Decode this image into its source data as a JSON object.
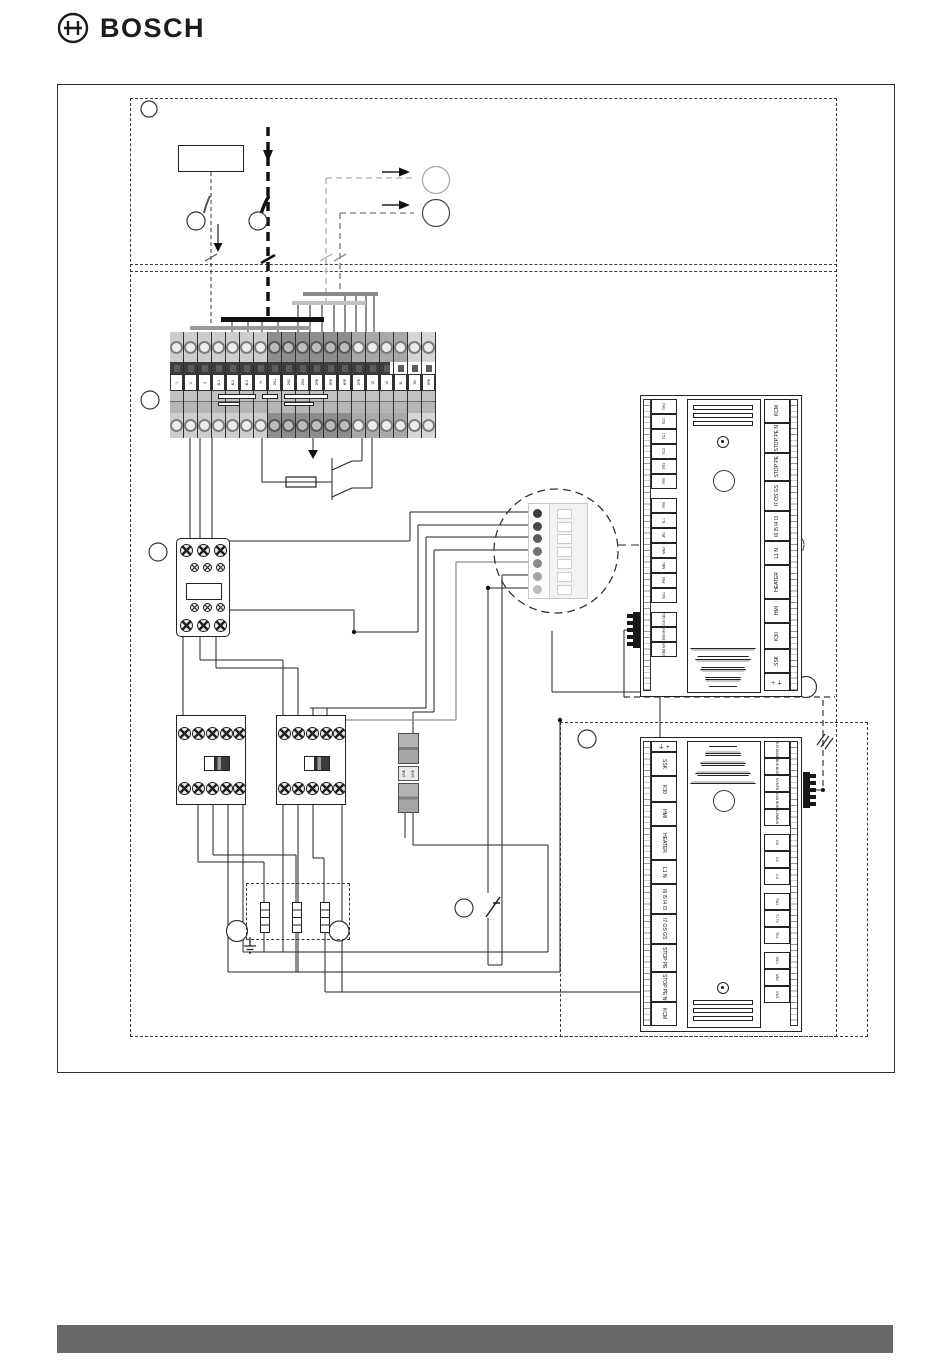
{
  "brand": {
    "logo_text": "BOSCH"
  },
  "footer": {
    "bar_color": "#686868"
  },
  "diagram": {
    "terminal_strip": {
      "labels": [
        "1",
        "2",
        "3",
        "4L1",
        "4L2",
        "4L3",
        "N",
        "2N1",
        "2N2",
        "2N3",
        "2PE",
        "3PE",
        "4PE",
        "1PE",
        "15",
        "16",
        "3L",
        "3N",
        "5PE"
      ]
    },
    "din_terminal": {
      "labels": [
        "1/NE",
        "2/NE"
      ]
    },
    "connector": {
      "pin_count": "7"
    },
    "board_top": {
      "left_labels": [
        "TW1",
        "TC0",
        "TC1",
        "TC3",
        "TR3",
        "TR5",
        "TR6",
        "TL1",
        "JR1",
        "MK2",
        "MB1",
        "PK5",
        "SO1",
        "SD08 SD18",
        "STB8 MVC",
        "STB8 MV3"
      ],
      "right_labels": [
        "KCM",
        "STOP PE N",
        "STOP PE",
        "I7 OS GS",
        "I6 I5 I4 I3",
        "L1 N",
        "HEATER",
        "HMI",
        "K30",
        "SSK"
      ],
      "symbol_cell": "+ ⏚"
    },
    "board_bottom": {
      "left_labels": [
        "SSK",
        "K30",
        "HMI",
        "HEATER",
        "L1 N",
        "I6 I5 I4 I3",
        "I7 OS GS",
        "STOP PE",
        "STOP PE N",
        "KCM"
      ],
      "right_labels": [
        "BUS DIAG",
        "BUS BUS",
        "NVMTB",
        "CAN BUS",
        "CANBUS",
        "I16",
        "I15",
        "I14",
        "TW1",
        "T1 T0",
        "TC1",
        "MC1",
        "MK2",
        "VW1"
      ],
      "symbol_cell": "⏚ +"
    }
  }
}
